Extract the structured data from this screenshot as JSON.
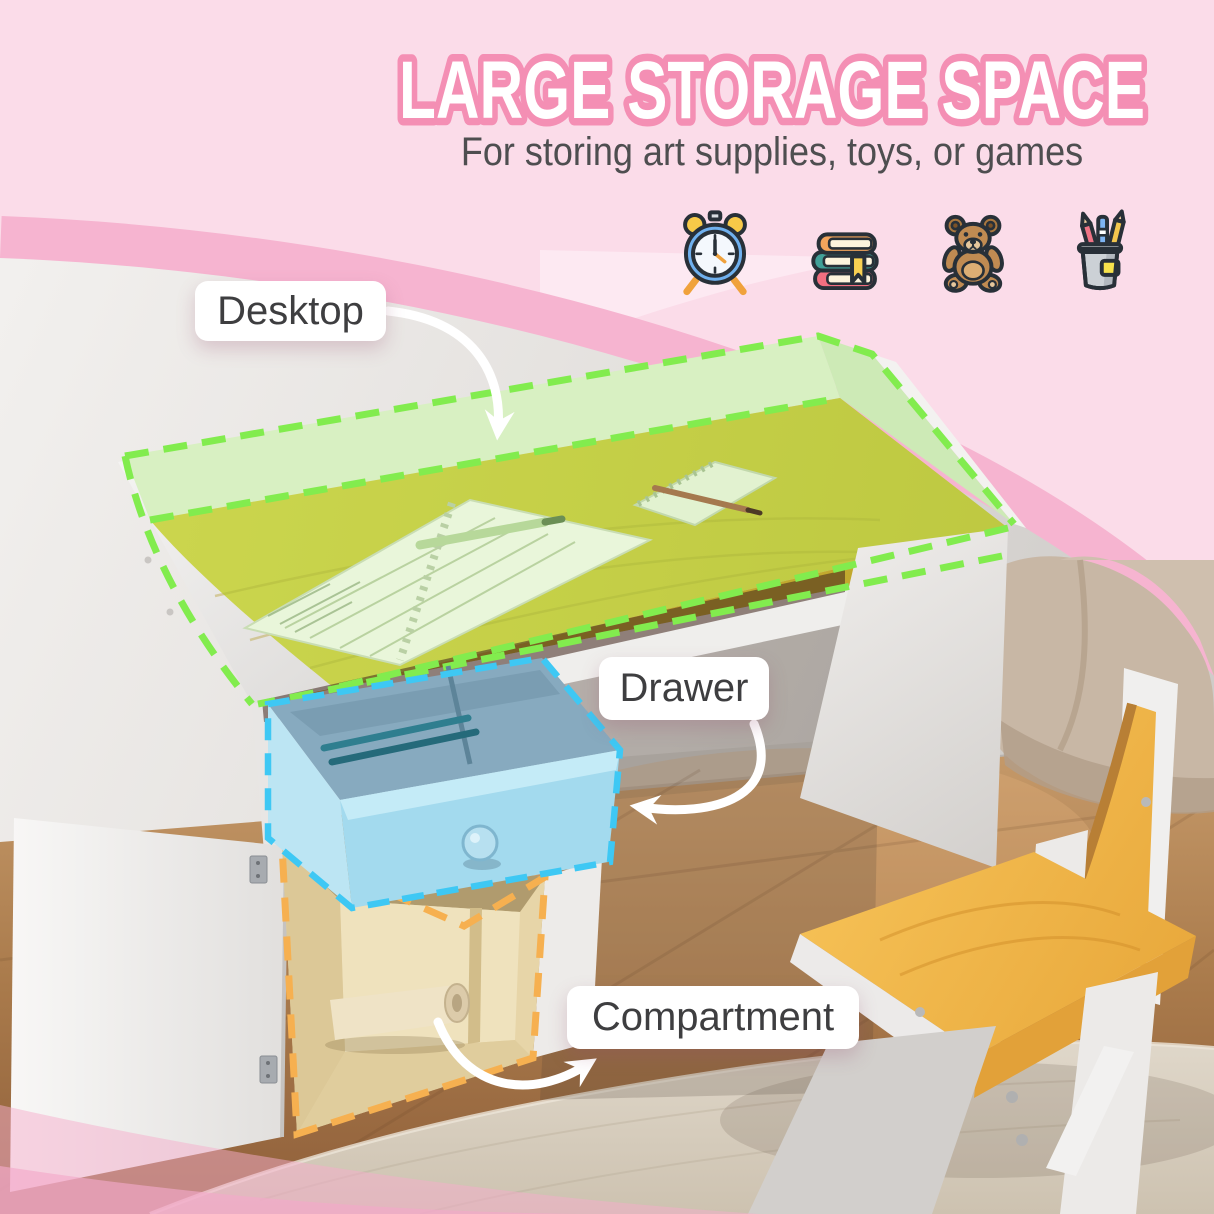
{
  "header": {
    "title": "LARGE STORAGE SPACE",
    "subtitle": "For storing art supplies, toys, or games"
  },
  "feature_icons": [
    {
      "name": "alarm-clock"
    },
    {
      "name": "book-stack"
    },
    {
      "name": "teddy-bear"
    },
    {
      "name": "pencil-holder"
    }
  ],
  "callouts": {
    "desktop": "Desktop",
    "drawer": "Drawer",
    "compartment": "Compartment"
  },
  "colors": {
    "background_pink": "#fbdce9",
    "arch_band_pink": "#f6b4d0",
    "title_fill": "#ffffff",
    "title_outline": "#f48fb4",
    "subtitle_text": "#4e4e50",
    "label_text": "#3e3e40",
    "desktop_highlight": "#82ec4e",
    "drawer_highlight": "#3ec8f4",
    "compartment_highlight": "#f6b050",
    "desk_wood": "#dcc63d",
    "chair_wood": "#f2b548"
  }
}
